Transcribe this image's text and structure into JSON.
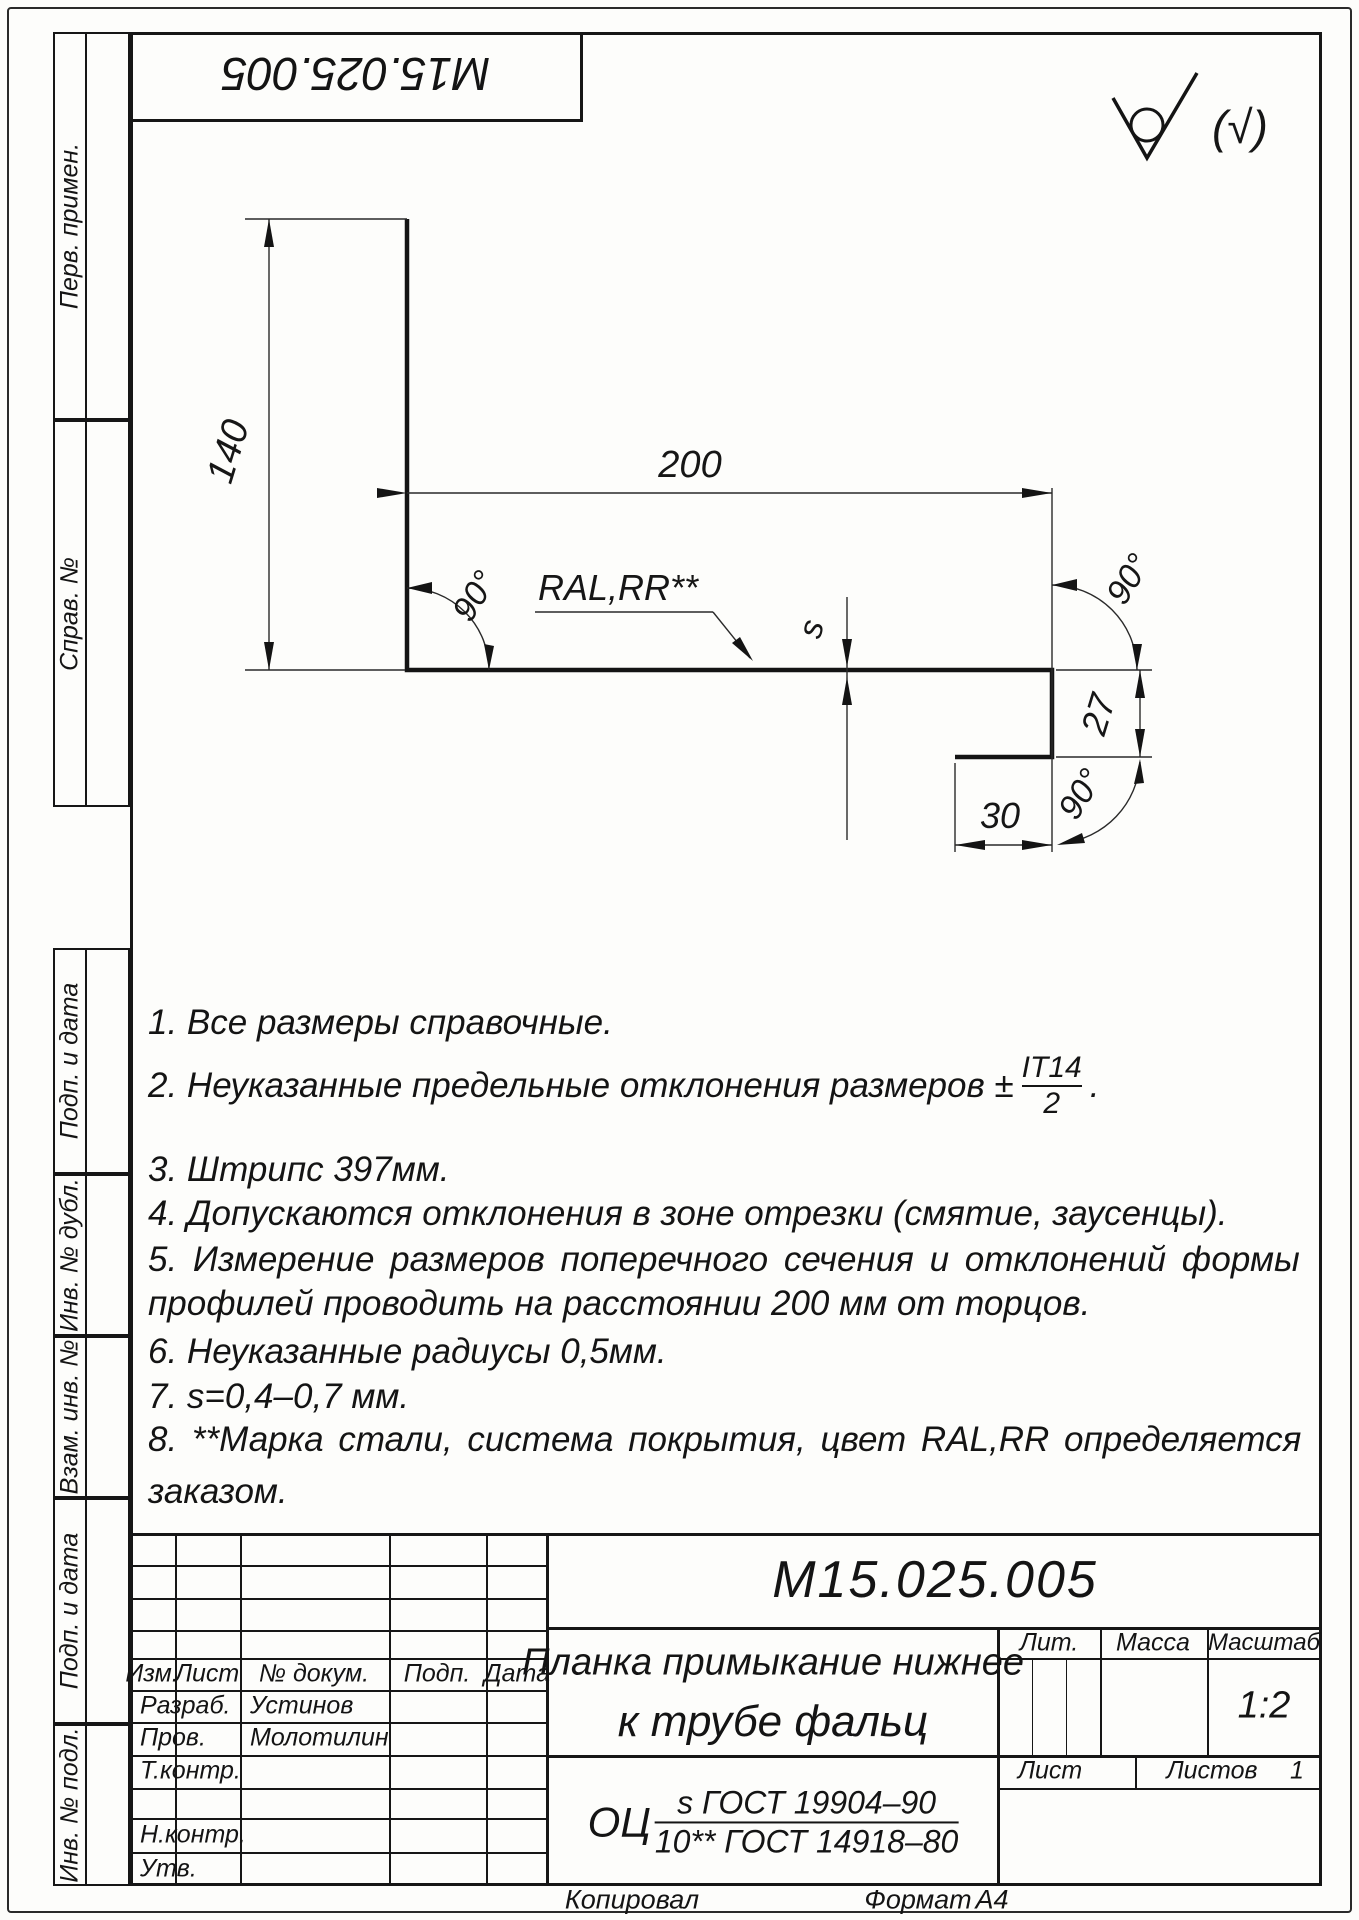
{
  "stamp": {
    "doc_number_top": "М15.025.005"
  },
  "surface_finish": {
    "note": "(√)"
  },
  "margin": {
    "labels": [
      "Перв. примен.",
      "Справ. №",
      "Подп. и дата",
      "Инв. № дубл.",
      "Взам. инв. №",
      "Подп. и дата",
      "Инв. № подл."
    ]
  },
  "drawing": {
    "dim_height": "140",
    "dim_length": "200",
    "dim_hook_height": "27",
    "dim_hook_width": "30",
    "angle": "90°",
    "thickness": "s",
    "coating": "RAL,RR**"
  },
  "notes": {
    "n1": "1.  Все размеры справочные.",
    "n2_prefix": "2.  Неуказанные предельные отклонения размеров ±",
    "n2_frac_num": "IT14",
    "n2_frac_den": "2",
    "n2_suffix": ".",
    "n3": "3.  Штрипс 397мм.",
    "n4": "4.  Допускаются отклонения в зоне отрезки (смятие, заусенцы).",
    "n5_line1": "5.  Измерение  размеров  поперечного  сечения  и  отклонений  формы",
    "n5_line2": "профилей проводить на расстоянии 200 мм от торцов.",
    "n6": "6.  Неуказанные радиусы 0,5мм.",
    "n7": "7.  s=0,4–0,7 мм.",
    "n8_line1": "8.  **Марка  стали,  система  покрытия,  цвет  RAL,RR  определяется",
    "n8_line2": "заказом."
  },
  "title_block": {
    "doc_number": "М15.025.005",
    "title_line1": "Планка примыкание нижнее",
    "title_line2": "к трубе фальц",
    "material_prefix": "ОЦ",
    "material_num": "s ГОСТ 19904–90",
    "material_den": "10** ГОСТ 14918–80",
    "headers": {
      "izm": "Изм.",
      "list": "Лист",
      "doc": "№ докум.",
      "podp": "Подп.",
      "data": "Дата"
    },
    "roles": {
      "razrab": "Разраб.",
      "prov": "Пров.",
      "tkontr": "Т.контр.",
      "nkontr": "Н.контр.",
      "utv": "Утв."
    },
    "people": {
      "razrab": "Устинов",
      "prov": "Молотилин"
    },
    "lit_label": "Лит.",
    "massa_label": "Масса",
    "masshtab_label": "Масштаб",
    "scale": "1:2",
    "list_label": "Лист",
    "listov_label": "Листов",
    "listov_value": "1"
  },
  "footer": {
    "kopiroval": "Копировал",
    "format_label": "Формат",
    "format_value": "А4"
  }
}
